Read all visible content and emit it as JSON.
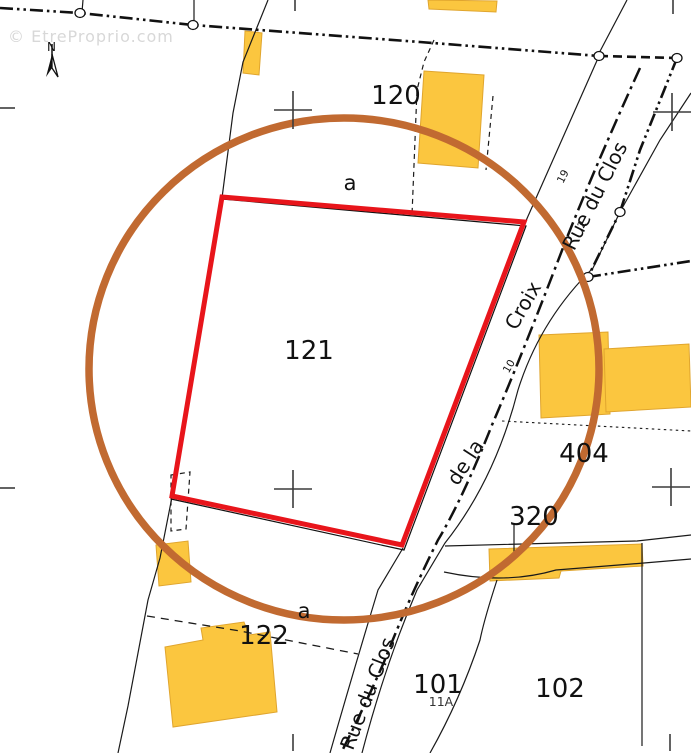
{
  "watermark": {
    "text": "© EtreProprio.com"
  },
  "compass": {
    "label": "N"
  },
  "parcels": {
    "p120": "120",
    "p121": "121",
    "p122": "122",
    "p101": "101",
    "p102": "102",
    "p404": "404",
    "p320": "320"
  },
  "subdivisions": {
    "a_top": "a",
    "a_bottom": "a"
  },
  "address_numbers": {
    "n19": "19",
    "n2": "2",
    "n10": "10",
    "n11a": "11A"
  },
  "streets": {
    "rue_du_clos_upper": "Rue du Clos",
    "rue_du_clos_lower": "Rue du Clos",
    "croix": "Croix",
    "de_la": "de la"
  },
  "colors": {
    "highlight_red": "#E8151B",
    "circle_brown": "#C16A31",
    "building_fill": "#FBC63F",
    "building_stroke": "#E0A52E",
    "boundary_black": "#111111",
    "cross_gray": "#3C3C3C",
    "watermark_gray": "#D8D8D8"
  }
}
